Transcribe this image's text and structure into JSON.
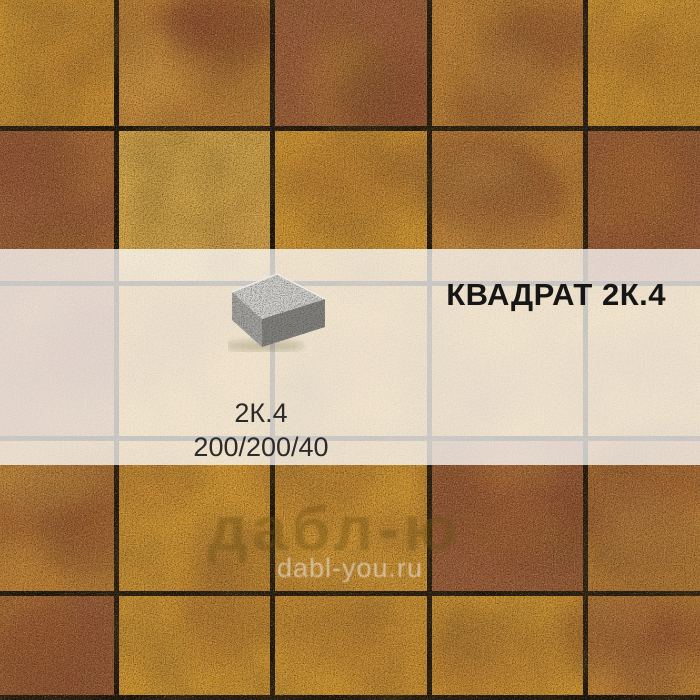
{
  "product": {
    "title": "КВАДРАТ 2К.4",
    "code": "2К.4",
    "dimensions": "200/200/40"
  },
  "watermark": {
    "brand": "дабл-ю",
    "site": "dabl-you.ru"
  },
  "colors": {
    "banner_overlay": "rgba(255,255,255,0.75)",
    "grout": "#1c1409",
    "title_text": "#161616",
    "spec_text": "#2b2b2b",
    "watermark_brand": "rgba(104,79,18,0.38)",
    "watermark_site": "rgba(240,238,244,0.55)",
    "block_top": "#d3d2cf",
    "block_left": "#a9a7a4",
    "block_right": "#868481",
    "block_edge_highlight": "#ecece9",
    "tile_gold": "#d2952f",
    "tile_gold_light": "#d9a848",
    "tile_red": "#9c5b36",
    "tile_mix": "#c08034",
    "tile_red_blotch": "#8a4a2a"
  },
  "paving": {
    "grid": {
      "rows": 5,
      "cols": 5
    },
    "grout_x": [
      114,
      270,
      427,
      583
    ],
    "grout_y": [
      126,
      281,
      436,
      591
    ],
    "bottom_edge_y": 695,
    "tile_map": [
      [
        "gold",
        "mix",
        "red",
        "mix",
        "gold"
      ],
      [
        "red",
        "gold_light",
        "gold",
        "mix",
        "red"
      ],
      [
        "red",
        "gold",
        "gold",
        "gold",
        "gold"
      ],
      [
        "mix",
        "gold",
        "gold",
        "red",
        "mix"
      ],
      [
        "red",
        "gold",
        "gold",
        "gold",
        "mix"
      ]
    ]
  }
}
